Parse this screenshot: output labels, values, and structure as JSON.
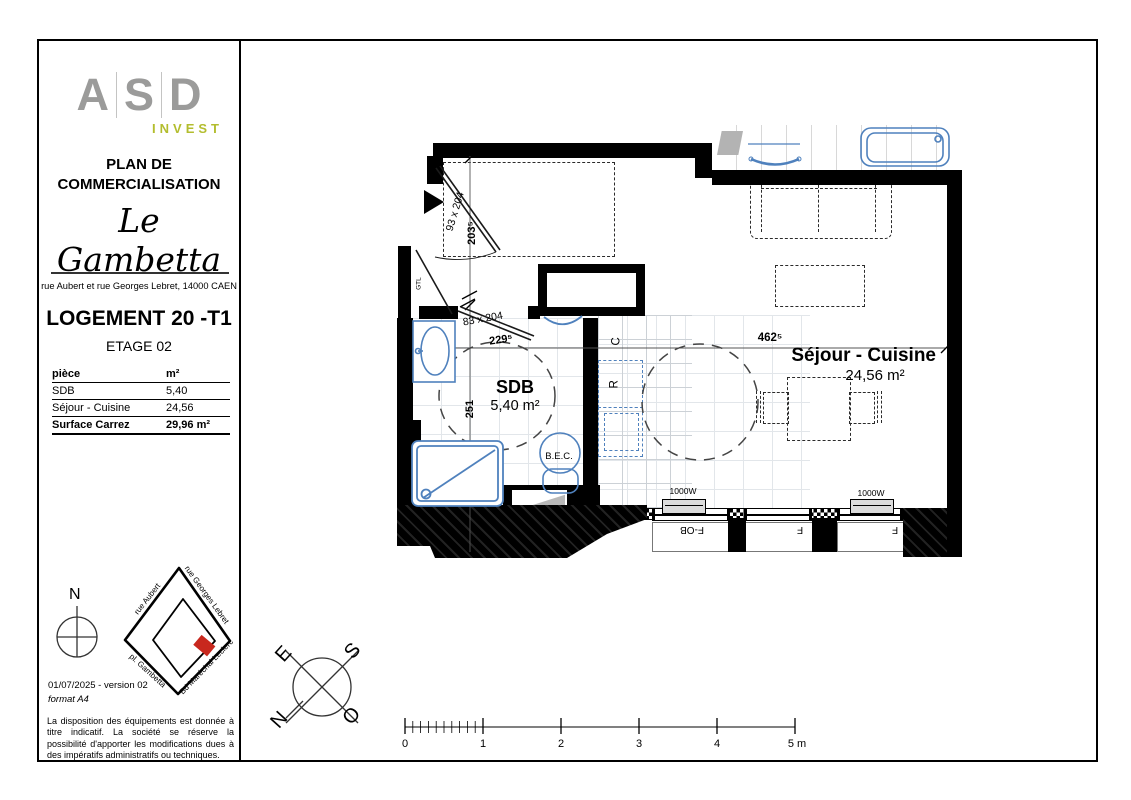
{
  "sidebar": {
    "logo": {
      "l1": "A",
      "l2": "S",
      "l3": "D",
      "sub": "INVEST"
    },
    "plan_title": "PLAN DE\nCOMMERCIALISATION",
    "project_name": "Le Gambetta",
    "address": "rue Aubert et rue Georges Lebret, 14000 CAEN",
    "unit": "LOGEMENT 20 -T1",
    "floor": "ETAGE 02",
    "table": {
      "col_piece": "pièce",
      "col_area": "m²",
      "rows": [
        {
          "piece": "SDB",
          "area": "5,40"
        },
        {
          "piece": "Séjour - Cuisine",
          "area": "24,56"
        }
      ],
      "total_label": "Surface Carrez",
      "total_area": "29,96 m²"
    },
    "north": "N",
    "map": {
      "street_top_left": "rue Aubert",
      "street_top_right": "rue Georges Lebret",
      "street_bottom_left": "pl. Gambetta",
      "street_bottom_right": "Bd Maréchal Leclerc"
    },
    "version_line": "01/07/2025 - version 02",
    "format_line": "format A4",
    "disclaimer": "La disposition des équipements est donnée à titre indicatif. La société se réserve la possibilité d'apporter les modifications dues à des impératifs administratifs ou techniques."
  },
  "plan": {
    "sdb_name": "SDB",
    "sdb_area": "5,40 m²",
    "sejour_name": "Séjour - Cuisine",
    "sejour_area": "24,56 m²",
    "dim_entry_door": "93 x 204",
    "dim_entry": "203⁵",
    "dim_bath_door": "83 x 204",
    "dim_bath_w": "229⁵",
    "dim_bath_h": "251",
    "dim_sejour_w": "462⁵",
    "gtl": "GTL",
    "bec": "B.E.C.",
    "kitchen_c": "C",
    "kitchen_r": "R",
    "radiator1": "1000W",
    "radiator2": "1000W",
    "window1": "F-OB",
    "window2": "F",
    "window3": "F"
  },
  "compass_rose": {
    "e": "E",
    "s": "S",
    "o": "O",
    "n": "N"
  },
  "scale_bar": {
    "t0": "0",
    "t1": "1",
    "t2": "2",
    "t3": "3",
    "t4": "4",
    "t5": "5 m"
  },
  "colors": {
    "fixture_blue": "#4f81bd",
    "logo_gray": "#9b9b9a",
    "logo_green": "#b3bd2e",
    "map_red": "#c8281e"
  }
}
